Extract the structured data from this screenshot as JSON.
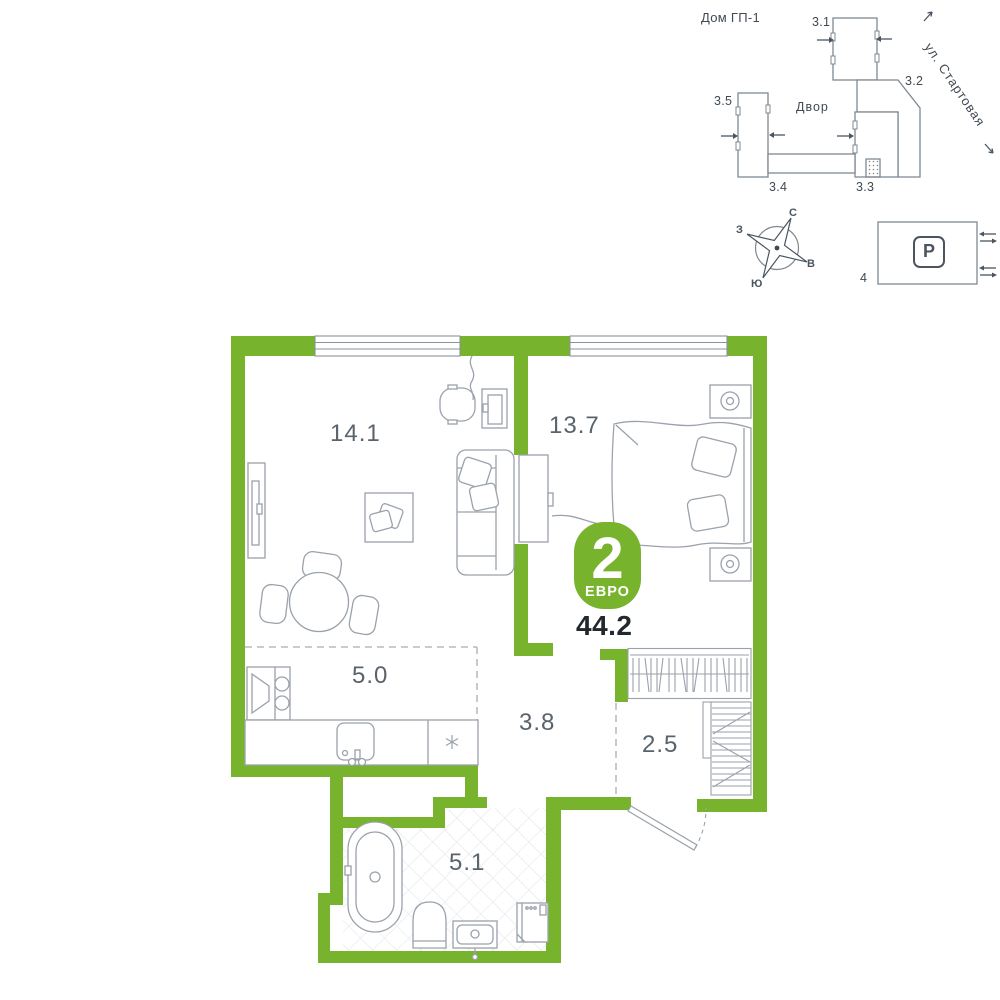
{
  "colors": {
    "accent": "#78b32e",
    "furniture_line": "#9aa2ab",
    "site_line": "#7e8891",
    "label_text": "#59636b",
    "dark_text": "#23282d",
    "tile_line": "#e3e7ea"
  },
  "site_plan": {
    "house_label": "Дом ГП-1",
    "courtyard_label": "Двор",
    "street_label": "ул. Стартовая",
    "buildings": {
      "b31": "3.1",
      "b32": "3.2",
      "b33": "3.3",
      "b34": "3.4",
      "b35": "3.5"
    }
  },
  "compass": {
    "north": "С",
    "east": "В",
    "south": "Ю",
    "west": "З"
  },
  "parking": {
    "symbol": "P",
    "number": "4"
  },
  "apartment": {
    "rooms_count": "2",
    "layout_type": "ЕВРО",
    "total_area": "44.2",
    "rooms": {
      "living": "14.1",
      "bedroom": "13.7",
      "kitchen": "5.0",
      "hallway": "3.8",
      "wardrobe": "2.5",
      "bathroom": "5.1"
    }
  }
}
